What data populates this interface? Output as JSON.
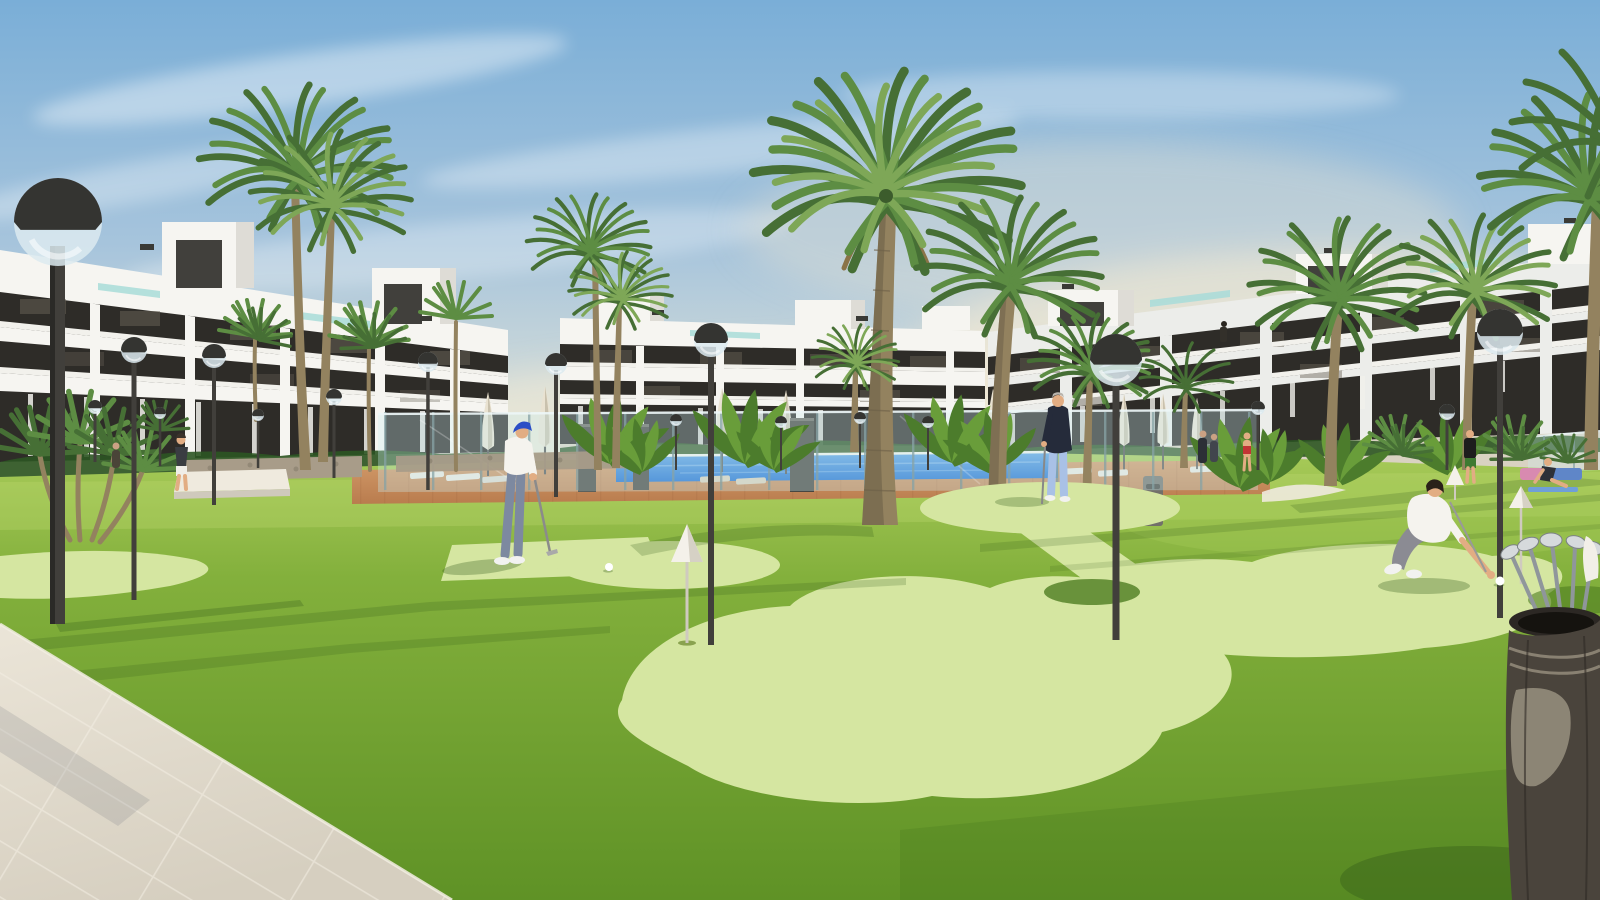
{
  "meta": {
    "type": "3D architectural rendering",
    "description": "Sunny resort courtyard of a modern white apartment complex: mini putting green on a lawn with cone markers, a golfer putting, a man holding a putter, a man crouching for his ball, globe street lamps, tall palm trees, a glass-fenced swimming pool with closed parasols and loungers, a golf bag with clubs in the foreground and a light tiled walkway at lower left."
  },
  "scene": {
    "buildings": [
      {
        "id": "left-block",
        "floors": 3,
        "style": "white modern slab facade with dark window bands and rooftop penthouses"
      },
      {
        "id": "center-block",
        "floors": 3,
        "style": "white modern slab facade with dark window bands"
      },
      {
        "id": "right-block",
        "floors": 3,
        "style": "white modern slab facade with dark window bands and rooftop penthouses"
      }
    ],
    "people": [
      "golfer in blue cap putting",
      "man in navy top holding putter",
      "man in white polo crouching to pick up ball",
      "person walking on path",
      "woman in red swimsuit at pool fence",
      "couple standing at pool fence",
      "person in black top and green shorts",
      "woman exercising on mat",
      "tiny figure on balcony"
    ],
    "objects": [
      "globe street lamps",
      "palm trees",
      "swimming pool",
      "glass pool fence",
      "closed parasols",
      "sun loungers",
      "putting greens with white cone markers",
      "golf balls",
      "golf bag with chrome clubs",
      "litter bin",
      "stone gabion wall",
      "white bench",
      "beige tiled walkway"
    ]
  },
  "colors": {
    "sky_top": "#7aaed7",
    "sky_mid": "#a6c4dc",
    "sky_low": "#d9dfd8",
    "sky_horizon": "#ece7d4",
    "cloud": "#ffffff",
    "haze": "#f0e9d5",
    "facade_white": "#f6f5f1",
    "facade_shade": "#dedcd6",
    "facade_cool": "#ecedea",
    "terrace": "#d9d2c2",
    "window_dark": "#2e2c28",
    "window_glint": "#6a6458",
    "glass_teal": "#a8dcd8",
    "rail_white": "#f2f1ec",
    "hedge": "#2c5522",
    "grass_far": "#a7ca58",
    "grass_mid": "#83b03c",
    "grass_near": "#5f9226",
    "grass_sun": "#bad66e",
    "shadow_green": "#2d5517",
    "green_light": "#d5e6a1",
    "green_dark": "#4e7d22",
    "pool_blue": "#1e6ecf",
    "pool_light": "#62a4e2",
    "paving": "#b97c4e",
    "paving_light": "#d29a69",
    "walkway": "#d6cfc0",
    "walkway_light": "#ebe5d8",
    "grout": "#f3eee3",
    "lamp_dark": "#343431",
    "lamp_glass": "#dceaf0",
    "pole": "#413f3b",
    "trunk": "#93825f",
    "trunk_shade": "#6d6048",
    "frond": "#5d8d43",
    "frond_dark": "#466f35",
    "frond_light": "#7ea757",
    "banana": "#4c7c2c",
    "banana_light": "#699d3a",
    "skin": "#e2ad83",
    "cap_blue": "#2b4ec6",
    "shirt_white": "#f5f3ee",
    "pants_gray": "#7d89a0",
    "jacket_navy": "#252b3a",
    "pants_blue": "#a9c1e6",
    "shoe_white": "#f2f2f0",
    "red": "#c23535",
    "shorts_green": "#3e7a31",
    "mat_blue": "#6f9fd8",
    "bench_pink": "#d88ab0",
    "stone": "#a89c89",
    "bench_white": "#efeade",
    "umbrella": "#e9e2d1",
    "umbrella_shade": "#c9c1ad",
    "fence_glass": "#cdeef2",
    "fence_post": "#87a3a6",
    "bin": "#72706a",
    "bag": "#4a443c",
    "bag_rim": "#2c2824",
    "bag_panel": "#98917f",
    "chrome": "#d6dadc",
    "steel": "#8f969b",
    "ball": "#ffffff",
    "cone": "#f4f1ea"
  }
}
